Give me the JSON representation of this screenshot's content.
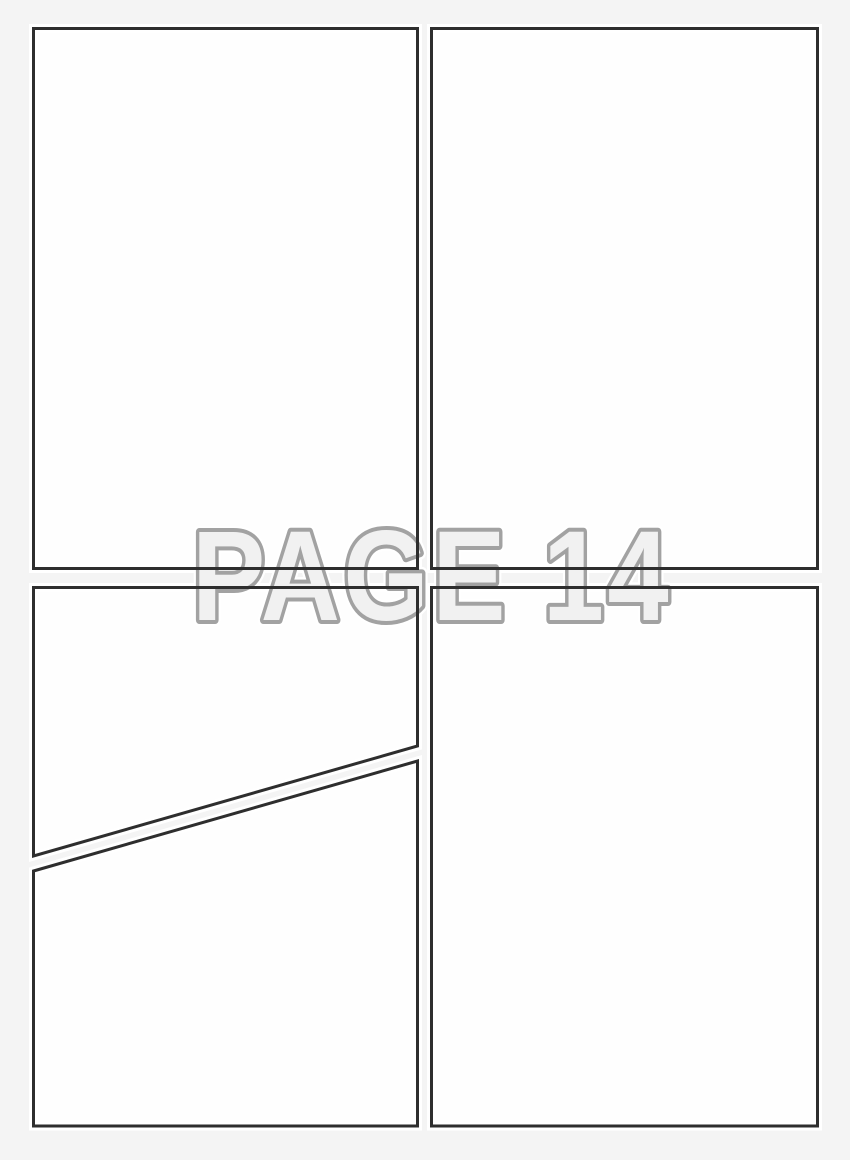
{
  "page": {
    "title": "PAGE 14"
  },
  "colors": {
    "background": "#f4f4f4",
    "panel_fill": "#fefefe",
    "panel_border": "#2e2e2e",
    "panel_halo": "#ffffff",
    "title_fill": "#f1f1f1",
    "title_outline": "#a2a2a2"
  },
  "panels": [
    {
      "name": "panel-top-left"
    },
    {
      "name": "panel-top-right"
    },
    {
      "name": "panel-middle-left-diagonal-upper"
    },
    {
      "name": "panel-bottom-left-diagonal-lower"
    },
    {
      "name": "panel-bottom-right"
    }
  ]
}
